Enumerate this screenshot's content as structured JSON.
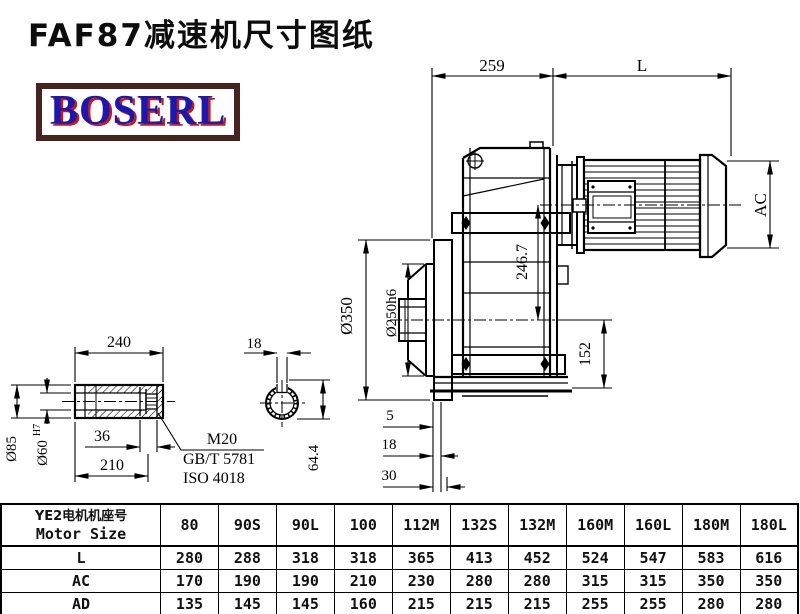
{
  "page": {
    "title": "FAF87减速机尺寸图纸",
    "logo_text": "BOSERL"
  },
  "colors": {
    "line": "#000000",
    "logo_text": "#1a18b4",
    "logo_shadow": "#c61a1a",
    "logo_border": "#46231d",
    "background": "#ffffff"
  },
  "drawing": {
    "dims": {
      "housing_width": "259",
      "motor_length": "L",
      "motor_diameter": "AC",
      "input_center_height": "246.7",
      "flange_diameter": "Ø350",
      "flange_spigot": "Ø250h6",
      "center_to_bottom": "152",
      "flange_step_1": "5",
      "flange_step_2": "18",
      "flange_step_3": "30",
      "shaft_length": "240",
      "shaft_od": "Ø85",
      "shaft_bore": "Ø60",
      "shaft_bore_tolerance": "H7",
      "bolt_engagement": "36",
      "shaft_inner_length": "210",
      "bolt_size": "M20",
      "bolt_standard_gb": "GB/T 5781",
      "bolt_standard_iso": "ISO 4018",
      "keyway_width": "18",
      "keyway_depth": "64.4"
    }
  },
  "table": {
    "header_label_cn": "YE2电机机座号",
    "header_label_en": "Motor Size",
    "motor_sizes": [
      "80",
      "90S",
      "90L",
      "100",
      "112M",
      "132S",
      "132M",
      "160M",
      "160L",
      "180M",
      "180L"
    ],
    "rows": [
      {
        "label": "L",
        "values": [
          "280",
          "288",
          "318",
          "318",
          "365",
          "413",
          "452",
          "524",
          "547",
          "583",
          "616"
        ]
      },
      {
        "label": "AC",
        "values": [
          "170",
          "190",
          "190",
          "210",
          "230",
          "280",
          "280",
          "315",
          "315",
          "350",
          "350"
        ]
      },
      {
        "label": "AD",
        "values": [
          "135",
          "145",
          "145",
          "160",
          "215",
          "215",
          "215",
          "255",
          "255",
          "280",
          "280"
        ]
      }
    ]
  }
}
